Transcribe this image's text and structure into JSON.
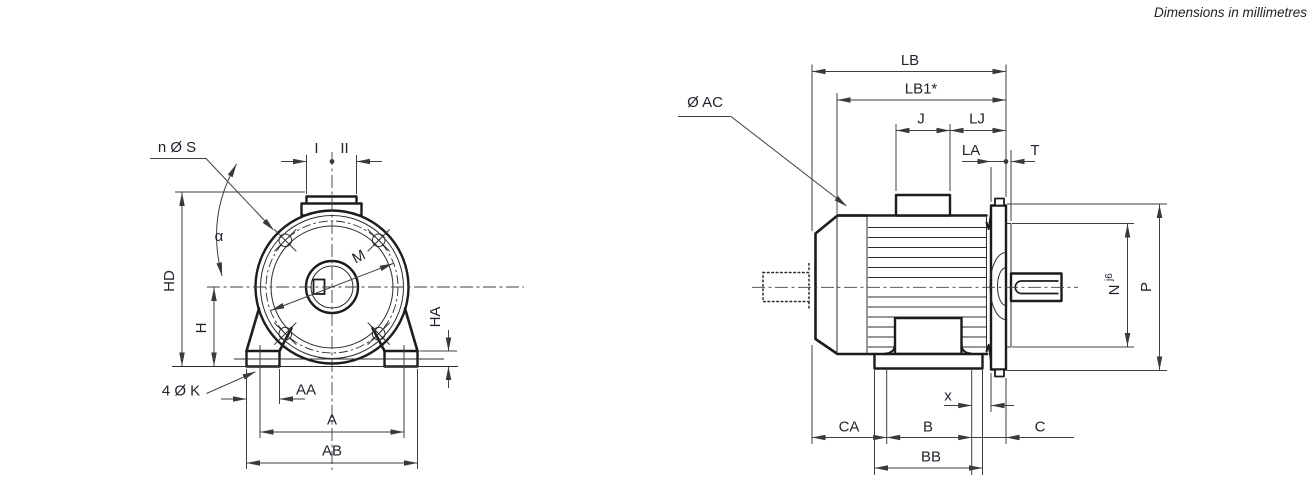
{
  "page": {
    "note": "Dimensions in millimetres"
  },
  "front": {
    "n_s": "n Ø S",
    "i": "I",
    "ii": "II",
    "alpha": "α",
    "hd": "HD",
    "h": "H",
    "m": "M",
    "ha": "HA",
    "k": "4 Ø K",
    "aa": "AA",
    "a": "A",
    "ab": "AB"
  },
  "side": {
    "ac": "Ø AC",
    "lb": "LB",
    "lb1": "LB1*",
    "j": "J",
    "lj": "LJ",
    "la": "LA",
    "t": "T",
    "n": "N",
    "n_sup": "j6",
    "p": "P",
    "ca": "CA",
    "b": "B",
    "x": "x",
    "bb": "BB",
    "c": "C"
  },
  "colors": {
    "outline": "#1c1c1c",
    "dimension": "#3f3f3f",
    "text": "#20242c",
    "background": "#ffffff"
  }
}
